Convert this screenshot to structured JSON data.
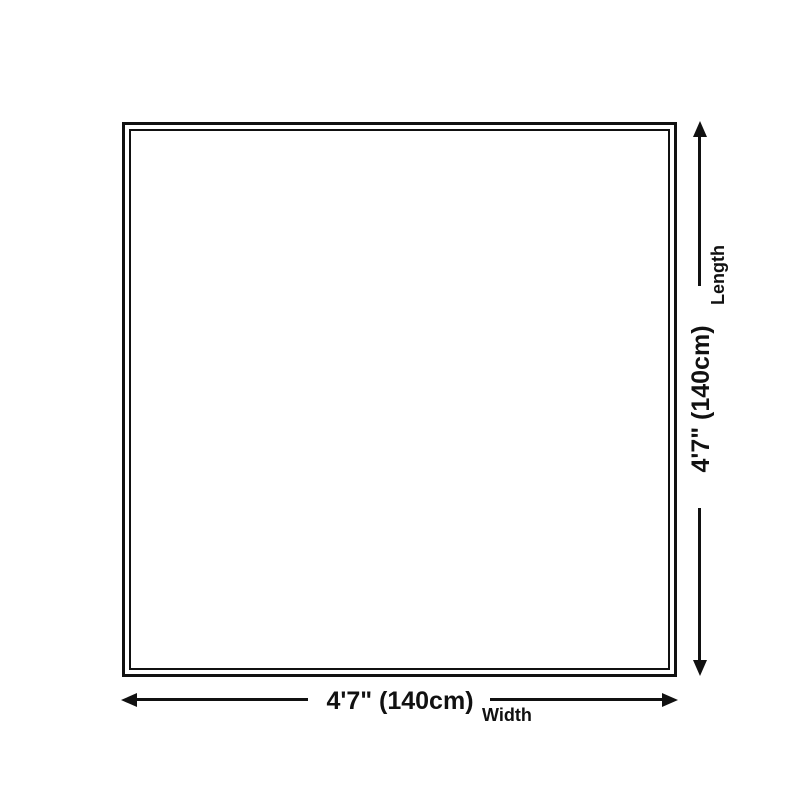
{
  "diagram": {
    "title": "product-size-diagram",
    "shape": "square",
    "width_value": "4'7\" (140cm)",
    "width_caption": "Width",
    "length_value": "4'7\" (140cm)",
    "length_caption": "Length",
    "line_color": "#111111",
    "background_color": "#ffffff"
  }
}
